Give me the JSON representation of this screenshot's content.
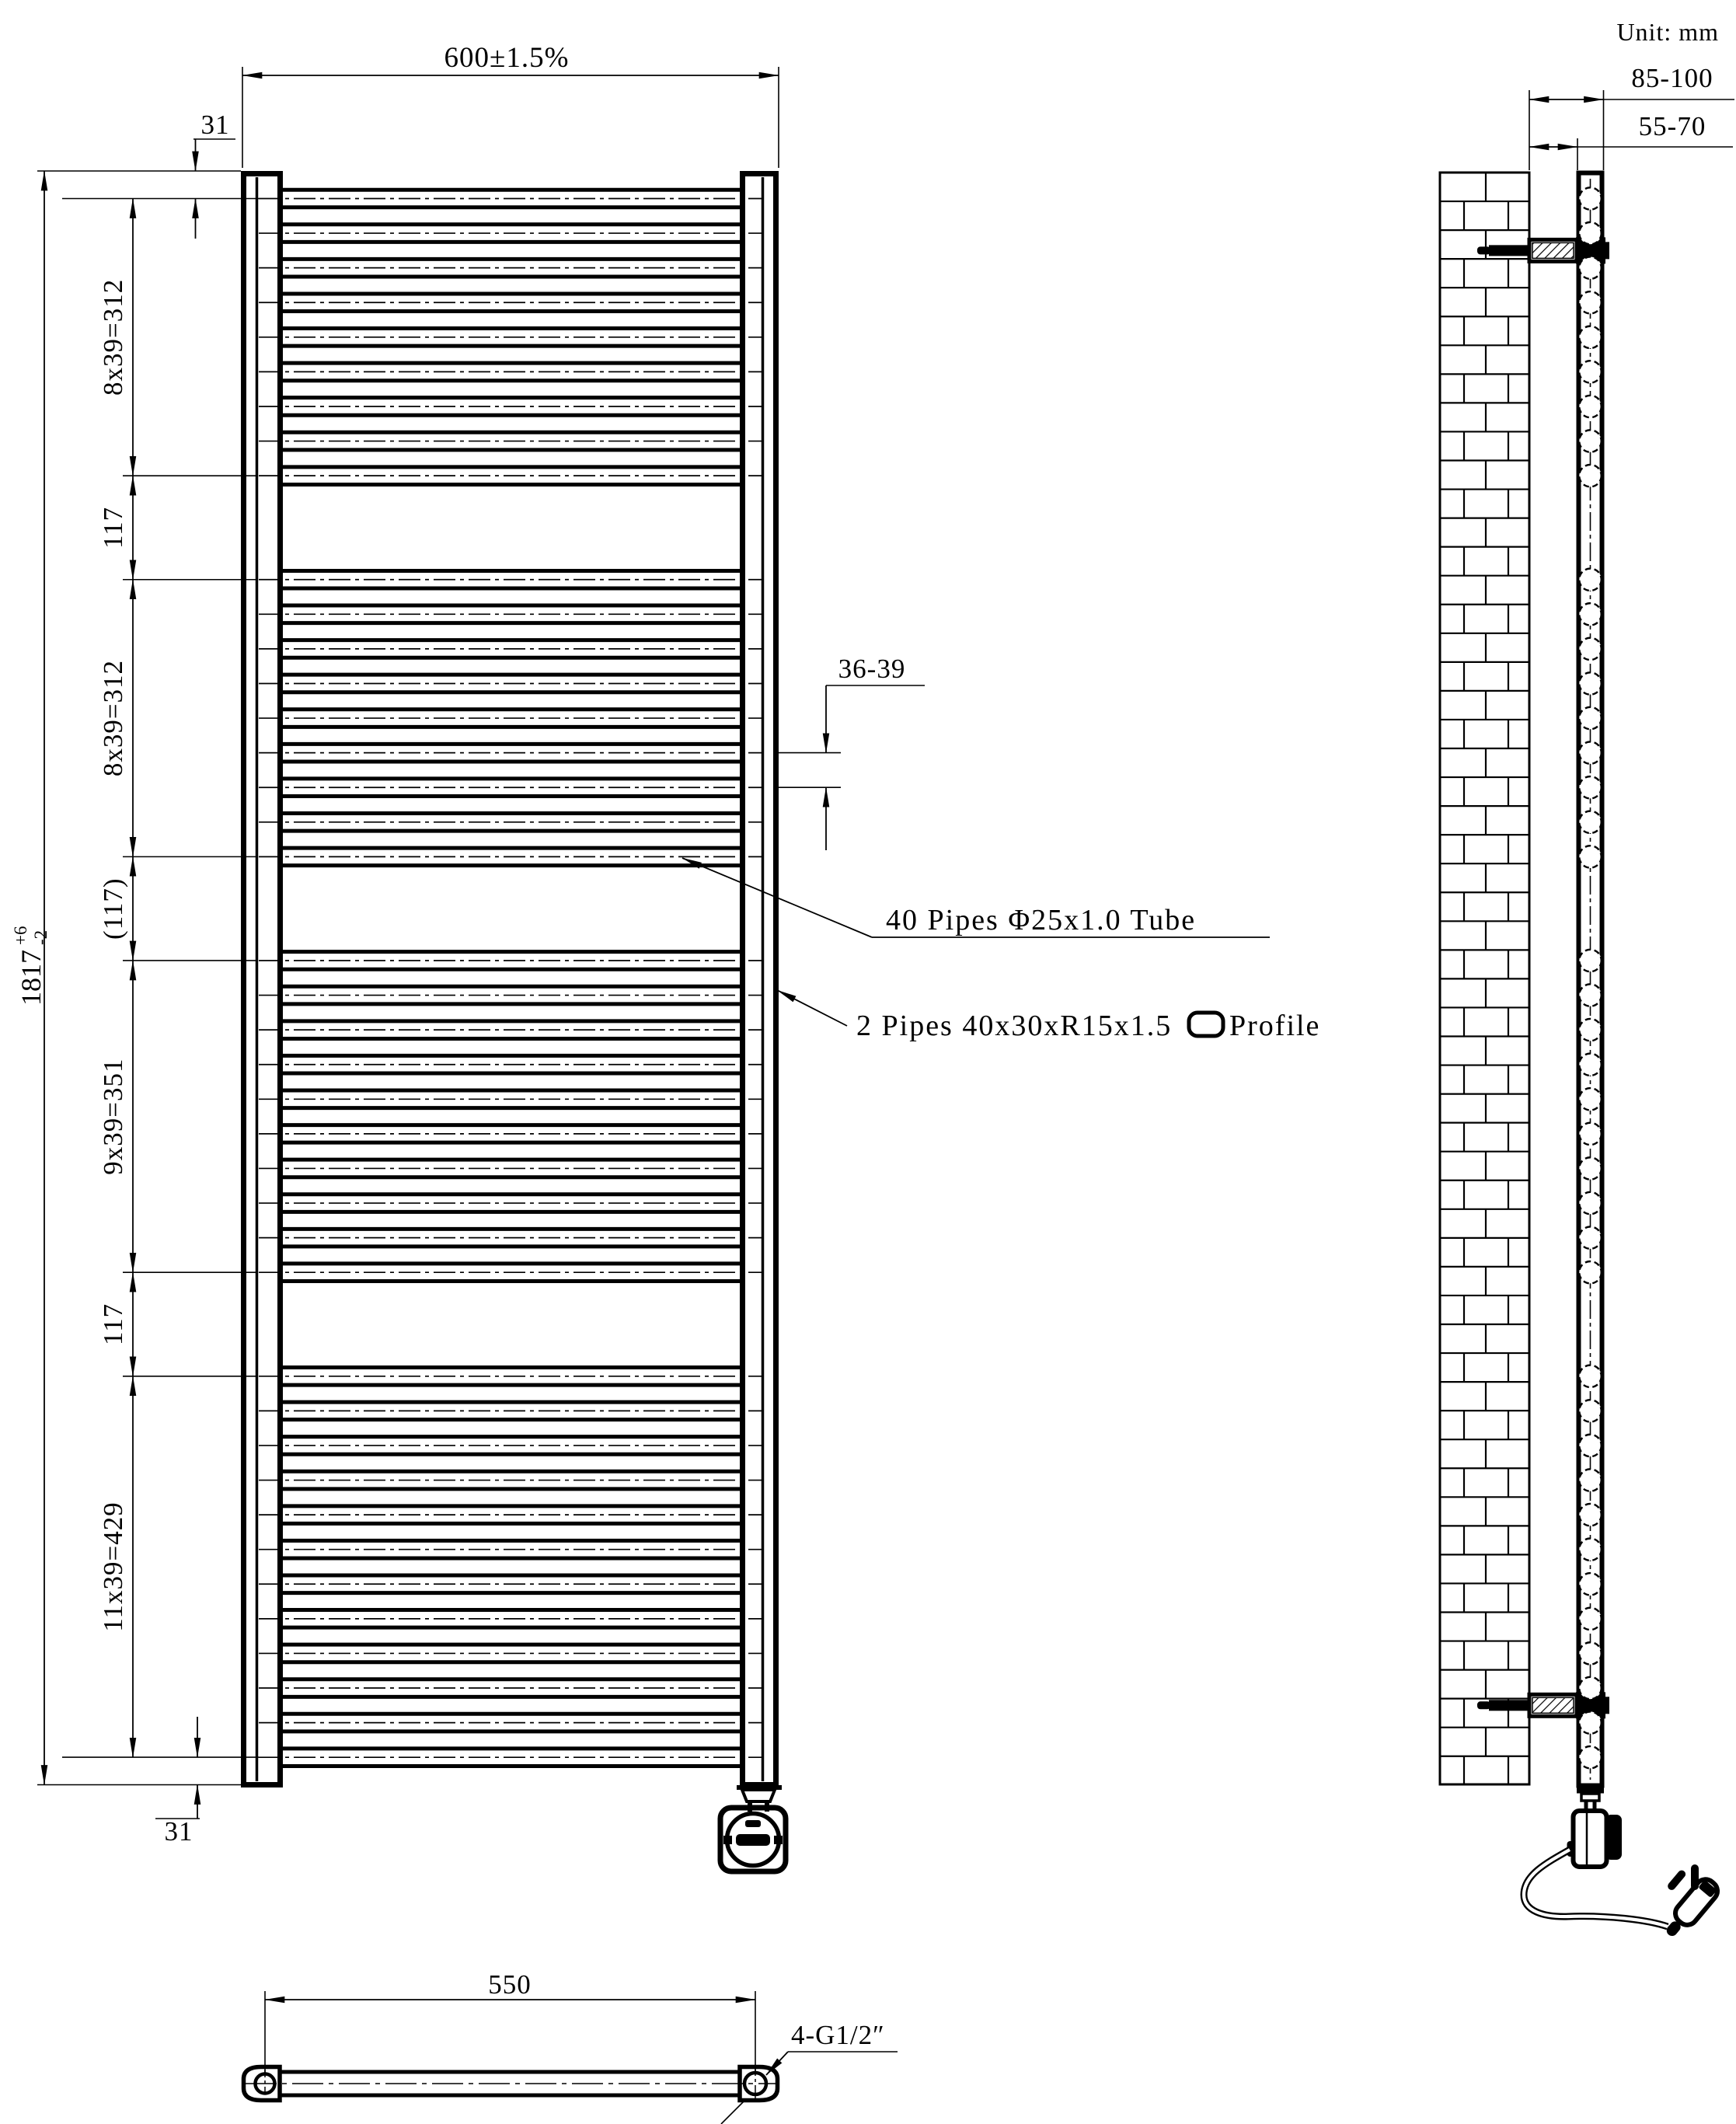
{
  "unit_label": "Unit: mm",
  "front_view": {
    "width_dim": "600±1.5%",
    "height_dim_main": "1817",
    "height_dim_sup": "+6",
    "height_dim_sub": "-2",
    "top_offset_dim": "31",
    "bottom_offset_dim": "31",
    "pitch_dim": "36-39",
    "segment_dims": [
      "8x39=312",
      "117",
      "8x39=312",
      "(117)",
      "9x39=351",
      "117",
      "11x39=429"
    ],
    "pipe_groups": [
      9,
      9,
      10,
      12
    ],
    "pipe_count": 40
  },
  "annotations": {
    "tube_note": "40 Pipes Φ25x1.0 Tube",
    "profile_note": "2 Pipes 40x30xR15x1.5",
    "profile_note_suffix": "Profile"
  },
  "side_view": {
    "depth_dim": "85-100",
    "gap_dim": "55-70"
  },
  "bottom_view": {
    "spacing_dim": "550",
    "thread_dim": "4-G1/2″"
  }
}
